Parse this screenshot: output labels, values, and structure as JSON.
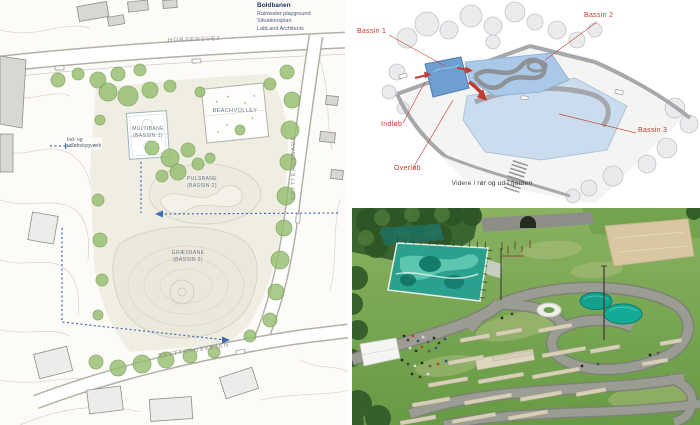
{
  "site_plan": {
    "streets": {
      "top": "HORSENSVEJ",
      "right": "SKYTTEHUSGADE",
      "bottom": "SKYTTEHUSVEJEN"
    },
    "labels": {
      "multibane_1": "MULTIBANE",
      "multibane_2": "(BASSIN 1)",
      "beachvolley": "BEACHVOLLEY",
      "pulsbane_1": "PULSBANE",
      "pulsbane_2": "(BASSIN 2)",
      "graesbane_1": "GRÆSBANE",
      "graesbane_2": "(BASSIN 3)",
      "inlet_1": "Ind- og",
      "inlet_2": "udløbsbygværk"
    },
    "title_block": {
      "title": "Boldbanen",
      "line2": "Rainwater playground",
      "line3": "Situationsplan",
      "line4": "LabLand Architects"
    }
  },
  "diagram": {
    "labels": {
      "bassin1": "Bassin 1",
      "bassin2": "Bassin 2",
      "bassin3": "Bassin 3",
      "inlet": "Indløb",
      "overflow": "Overløb",
      "outflow": "Videre i rør og ud i fjorden"
    }
  },
  "theme": {
    "label-red": "#c23a31",
    "flow-blue": "#3d6cb3",
    "basin1": "#6f9fd2",
    "basin2": "#aac8e8",
    "basin3": "#cadcee",
    "court-teal": "#2aa18c",
    "sand": "#d8c7a2",
    "lawn": "#7cab55",
    "title-navy": "#233a60"
  }
}
